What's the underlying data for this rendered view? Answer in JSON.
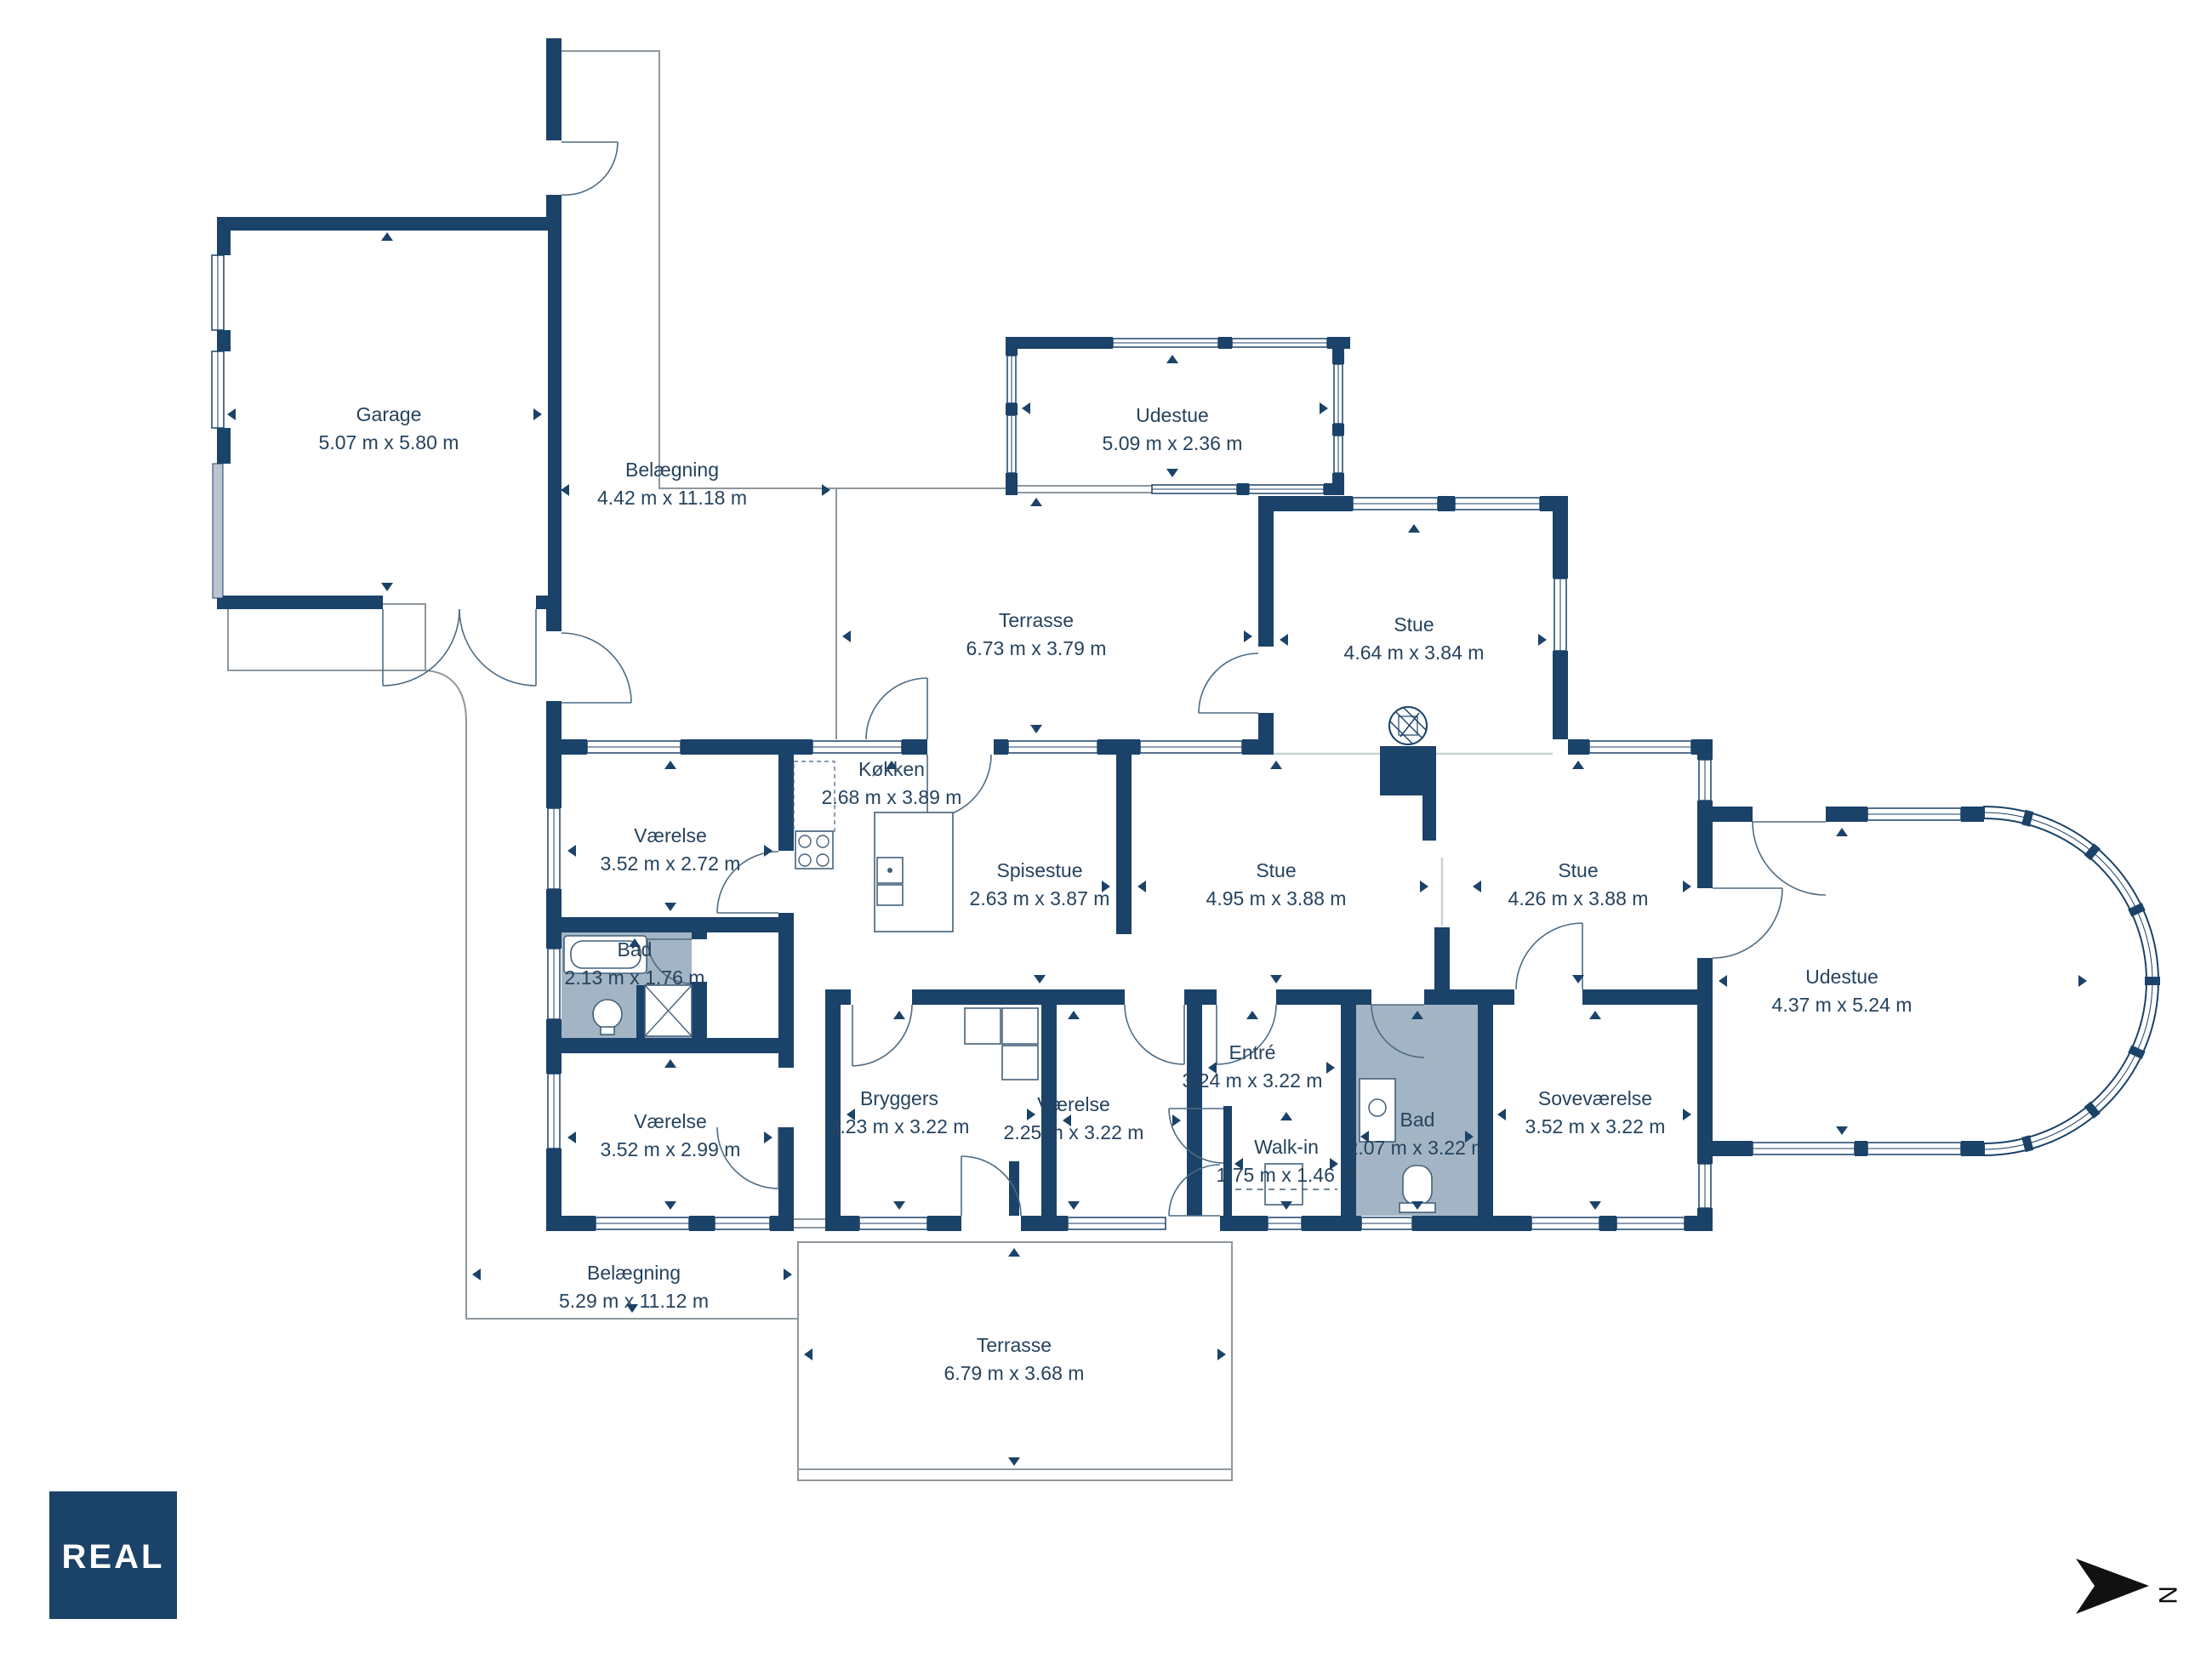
{
  "meta": {
    "brand": "REAL",
    "north_label": "N"
  },
  "colors": {
    "wall": "#1b4268",
    "bad_fill": "#a3b5c4",
    "outline": "#8f979d",
    "door": "#4e6b82",
    "beam": "#ccd2d6",
    "text": "#25435e",
    "fixture": "#44607a",
    "garage_door": "#b9c6d2",
    "logo_bg": "#1b4268",
    "logo_text": "#ffffff",
    "north": "#111111"
  },
  "rooms": [
    {
      "id": "garage",
      "name": "Garage",
      "dims": "5.07 m x 5.80 m"
    },
    {
      "id": "belaegning-top",
      "name": "Belægning",
      "dims": "4.42 m x 11.18 m"
    },
    {
      "id": "udestue-top",
      "name": "Udestue",
      "dims": "5.09 m x 2.36 m"
    },
    {
      "id": "terrasse-top",
      "name": "Terrasse",
      "dims": "6.73 m x 3.79 m"
    },
    {
      "id": "stue-top",
      "name": "Stue",
      "dims": "4.64 m x 3.84 m"
    },
    {
      "id": "vaerelse-1",
      "name": "Værelse",
      "dims": "3.52 m x 2.72 m"
    },
    {
      "id": "koekken",
      "name": "Køkken",
      "dims": "2.68 m x 3.89 m"
    },
    {
      "id": "spisestue",
      "name": "Spisestue",
      "dims": "2.63 m x 3.87 m"
    },
    {
      "id": "stue-1",
      "name": "Stue",
      "dims": "4.95 m x 3.88 m"
    },
    {
      "id": "stue-2",
      "name": "Stue",
      "dims": "4.26 m x 3.88 m"
    },
    {
      "id": "bad-1",
      "name": "Bad",
      "dims": "2.13 m x 1.76 m"
    },
    {
      "id": "vaerelse-2",
      "name": "Værelse",
      "dims": "3.52 m x 2.99 m"
    },
    {
      "id": "bryggers",
      "name": "Bryggers",
      "dims": "3.23 m x 3.22 m"
    },
    {
      "id": "vaerelse-3",
      "name": "Værelse",
      "dims": "2.25 m x 3.22 m"
    },
    {
      "id": "entre",
      "name": "Entré",
      "dims": "3.24 m x 3.22 m"
    },
    {
      "id": "walk-in",
      "name": "Walk-in",
      "dims": "1.75 m x 1.46 m"
    },
    {
      "id": "bad-2",
      "name": "Bad",
      "dims": "2.07 m x 3.22 m"
    },
    {
      "id": "sovevaerelse",
      "name": "Soveværelse",
      "dims": "3.52 m x 3.22 m"
    },
    {
      "id": "udestue-right",
      "name": "Udestue",
      "dims": "4.37 m x 5.24 m"
    },
    {
      "id": "belaegning-bottom",
      "name": "Belægning",
      "dims": "5.29 m x 11.12 m"
    },
    {
      "id": "terrasse-bottom",
      "name": "Terrasse",
      "dims": "6.79 m x 3.68 m"
    }
  ]
}
